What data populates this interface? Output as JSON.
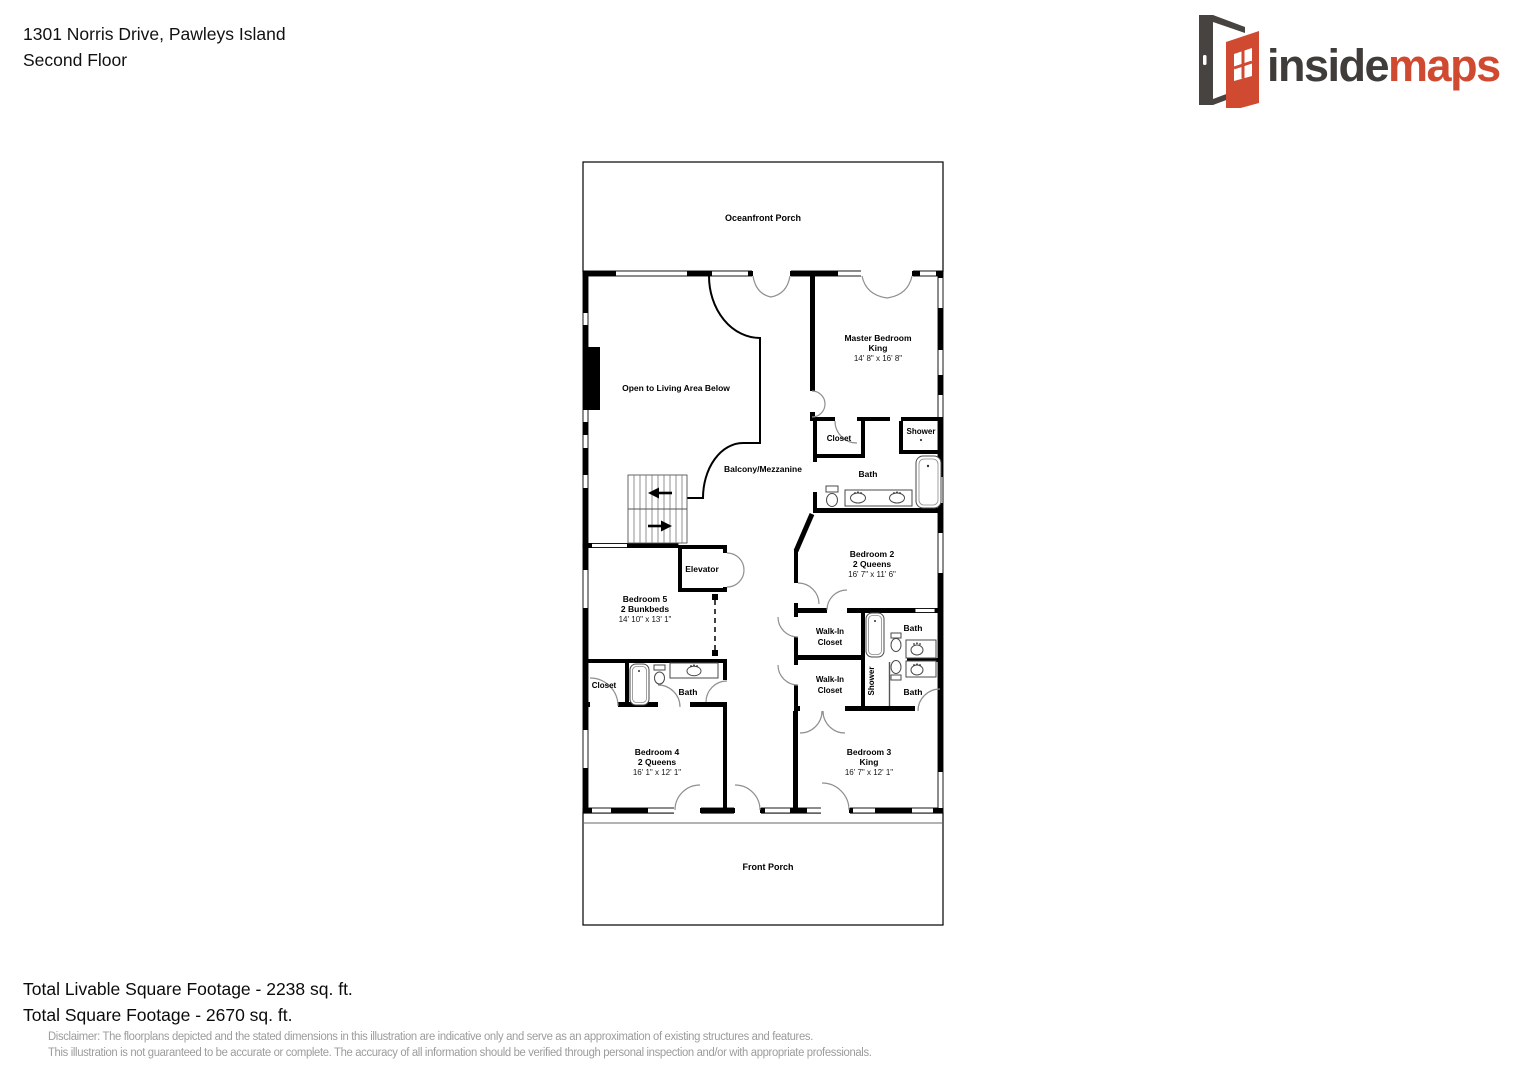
{
  "header": {
    "address": "1301 Norris Drive, Pawleys Island",
    "floor": "Second Floor"
  },
  "logo": {
    "word_primary": "inside",
    "word_secondary": "maps",
    "colors": {
      "primary": "#3f3c3a",
      "secondary": "#cf4a31",
      "door_frame": "#474340"
    }
  },
  "floorplan": {
    "porches": {
      "top": "Oceanfront Porch",
      "bottom": "Front Porch"
    },
    "areas": {
      "open_below": "Open to Living Area Below",
      "balcony": "Balcony/Mezzanine",
      "elevator": "Elevator"
    },
    "rooms": {
      "master": {
        "name": "Master Bedroom",
        "bed": "King",
        "dims": "14' 8\" x 16' 8\""
      },
      "bedroom2": {
        "name": "Bedroom 2",
        "bed": "2 Queens",
        "dims": "16' 7\" x 11' 6\""
      },
      "bedroom3": {
        "name": "Bedroom 3",
        "bed": "King",
        "dims": "16' 7\" x 12' 1\""
      },
      "bedroom4": {
        "name": "Bedroom 4",
        "bed": "2 Queens",
        "dims": "16' 1\" x 12' 1\""
      },
      "bedroom5": {
        "name": "Bedroom 5",
        "bed": "2 Bunkbeds",
        "dims": "14' 10\" x 13' 1\""
      }
    },
    "labels": {
      "closet": "Closet",
      "bath": "Bath",
      "shower": "Shower",
      "walk_in_line1": "Walk-In",
      "walk_in_line2": "Closet"
    },
    "wall_color": "#000000",
    "door_arc_color": "#8f8f8f"
  },
  "footer": {
    "livable": "Total Livable Square Footage - 2238 sq. ft.",
    "total": "Total Square Footage - 2670 sq. ft."
  },
  "disclaimer": {
    "line1": "Disclaimer: The floorplans depicted and the stated dimensions in this illustration are indicative only and serve as an approximation of existing structures and features.",
    "line2": "This illustration is not guaranteed to be accurate or complete. The accuracy of all information should be verified through personal inspection and/or with appropriate professionals."
  }
}
